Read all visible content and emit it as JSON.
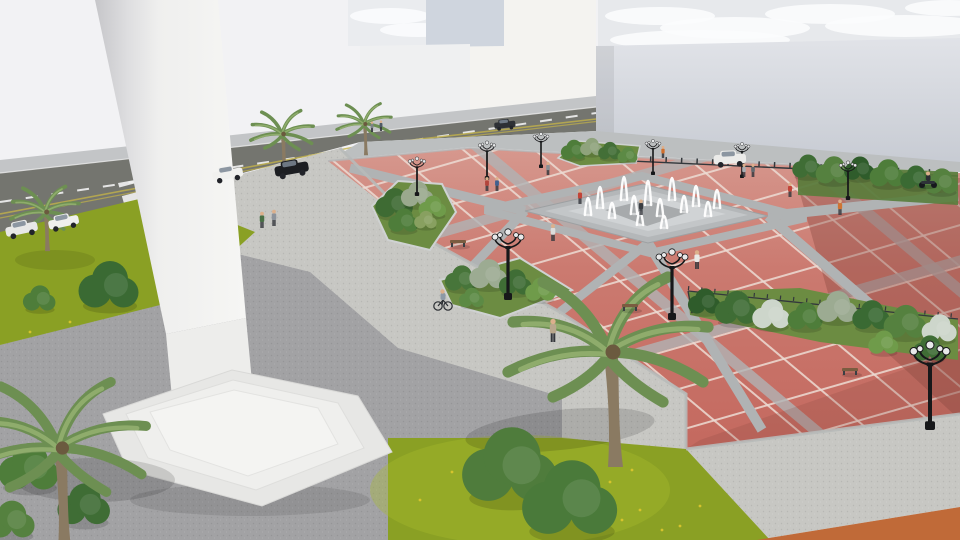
{
  "scene": {
    "description": "3D architectural rendering of a public plaza: white monument on stepped base at left, red paved square with diamond grid, central fountain with water jets, landscaped planters, palm trees, ornate lamp posts, street with cars at top and large white buildings"
  },
  "palette": {
    "sky": "#f2f2f4",
    "cloud_band": "#e7e9ec",
    "cloud": "#fbfcfd",
    "wall_top": "#e1e3e8",
    "wall_bottom": "#c6cad2",
    "building_white": "#eff0f1",
    "building_cream": "#f4f3f0",
    "building_blue": "#cfd5de",
    "street": "#74756f",
    "sidewalk_far": "#c3c5c7",
    "sidewalk_strip": "#bcbfc0",
    "walkway": "#c7c7c3",
    "plaza_gray": "#a2a2a4",
    "grass": "#8aa024",
    "grass_light": "#a8bc2e",
    "flower": "#e2c92f",
    "red_top": "#d6988e",
    "red_mid": "#cb7a70",
    "red_low": "#c4695f",
    "red_dark": "#8a4740",
    "grid_line": "#ecdcd4",
    "grid_band": "#b0b3b4",
    "curb": "#b7bab9",
    "fountain_outer": "#b4b7b9",
    "fountain_mid": "#c3c6c8",
    "fountain_inner": "#d0d3d5",
    "fountain_core": "#a7aaac",
    "water": "#ffffff",
    "monument_edge": "#c6c6c9",
    "monument_face": "#f6f6f4",
    "base1": "#e7e7e5",
    "base2": "#efefed",
    "base3": "#f4f4f2",
    "hedge": "#6c8c42",
    "palm_frond": "#6d8f52",
    "palm_frond_light": "#8fac6c",
    "trunk": "#8a7a62",
    "metal": "#17181a",
    "fence": "#33383c",
    "skin": "#dcb08c",
    "dirt": "#c06a38",
    "mark_white": "#f2f2f2",
    "mark_yellow": "#c2b14a"
  },
  "objects": {
    "clouds": [
      [
        660,
        16,
        55,
        9
      ],
      [
        735,
        28,
        75,
        11
      ],
      [
        830,
        14,
        65,
        10
      ],
      [
        905,
        26,
        80,
        11
      ],
      [
        700,
        40,
        90,
        10
      ],
      [
        950,
        8,
        45,
        8
      ],
      [
        390,
        16,
        40,
        8
      ],
      [
        418,
        30,
        38,
        7
      ]
    ],
    "palms": [
      [
        45,
        212,
        0.85
      ],
      [
        282,
        134,
        0.78
      ],
      [
        364,
        124,
        0.68
      ],
      [
        608,
        352,
        2.5
      ],
      [
        58,
        448,
        2.2
      ]
    ],
    "lamps": [
      [
        417,
        196,
        0.55
      ],
      [
        487,
        180,
        0.55
      ],
      [
        541,
        168,
        0.5
      ],
      [
        508,
        300,
        1.0
      ],
      [
        653,
        175,
        0.5
      ],
      [
        742,
        178,
        0.5
      ],
      [
        848,
        200,
        0.55
      ],
      [
        672,
        320,
        1.0
      ],
      [
        930,
        430,
        1.25
      ]
    ],
    "bushes": [
      [
        395,
        205,
        15,
        "#3e6b33"
      ],
      [
        418,
        196,
        13,
        "#9aa98e"
      ],
      [
        433,
        208,
        11,
        "#6f9b4a"
      ],
      [
        404,
        222,
        12,
        "#4e7d3a"
      ],
      [
        426,
        221,
        9,
        "#88a060"
      ],
      [
        462,
        280,
        13,
        "#47753a"
      ],
      [
        489,
        276,
        15,
        "#9cab92"
      ],
      [
        516,
        284,
        13,
        "#3f6d35"
      ],
      [
        541,
        291,
        12,
        "#6f9b4a"
      ],
      [
        472,
        299,
        10,
        "#5c8a45"
      ],
      [
        574,
        151,
        10,
        "#4e7d3a"
      ],
      [
        592,
        148,
        9,
        "#8fa37c"
      ],
      [
        610,
        152,
        9,
        "#436f37"
      ],
      [
        628,
        156,
        8,
        "#5c8a45"
      ],
      [
        808,
        168,
        12,
        "#3f6d35"
      ],
      [
        834,
        172,
        14,
        "#55813f"
      ],
      [
        860,
        170,
        12,
        "#2f5c2b"
      ],
      [
        888,
        175,
        14,
        "#4e7d3a"
      ],
      [
        916,
        179,
        12,
        "#3a6a33"
      ],
      [
        942,
        183,
        13,
        "#55813f"
      ],
      [
        705,
        303,
        13,
        "#2f5c2b"
      ],
      [
        737,
        310,
        17,
        "#3f6d35"
      ],
      [
        772,
        316,
        15,
        "#cdd6cb"
      ],
      [
        806,
        318,
        14,
        "#4e7d3a"
      ],
      [
        838,
        309,
        16,
        "#9cab92"
      ],
      [
        872,
        317,
        15,
        "#3a6a33"
      ],
      [
        906,
        324,
        17,
        "#55813f"
      ],
      [
        940,
        330,
        14,
        "#cdd6cb"
      ],
      [
        884,
        344,
        12,
        "#6f9b4a"
      ],
      [
        930,
        350,
        13,
        "#3f6d35"
      ],
      [
        110,
        288,
        24,
        "#3a6a33"
      ],
      [
        40,
        300,
        13,
        "#4e7d3a"
      ],
      [
        30,
        470,
        24,
        "#4e7d3a"
      ],
      [
        85,
        507,
        21,
        "#3f6d35"
      ],
      [
        12,
        522,
        19,
        "#55813f"
      ],
      [
        512,
        470,
        38,
        "#4f7c3c"
      ],
      [
        572,
        503,
        38,
        "#4a7a3a"
      ]
    ],
    "cars": [
      [
        228,
        176,
        0.9,
        "#f1f1ef",
        -10
      ],
      [
        292,
        171,
        1.0,
        "#1c1e22",
        -10
      ],
      [
        505,
        126,
        0.62,
        "#2d3035",
        -6
      ],
      [
        64,
        224,
        0.9,
        "#efefed",
        -12
      ],
      [
        22,
        231,
        0.95,
        "#e8e8e6",
        -12
      ],
      [
        730,
        161,
        0.95,
        "#ebebe9",
        -3
      ]
    ],
    "people": [
      [
        262,
        228,
        "#4a7046"
      ],
      [
        274,
        226,
        "#8d939b"
      ],
      [
        487,
        191,
        "#b3453c"
      ],
      [
        497,
        191,
        "#41608f"
      ],
      [
        548,
        175,
        "#8a8f94"
      ],
      [
        580,
        204,
        "#c24438"
      ],
      [
        553,
        241,
        "#dcdcda"
      ],
      [
        641,
        215,
        "#3a3d42"
      ],
      [
        697,
        269,
        "#e9e9e7"
      ],
      [
        744,
        177,
        "#a9adb2"
      ],
      [
        753,
        177,
        "#62686e"
      ],
      [
        790,
        197,
        "#c24438"
      ],
      [
        840,
        215,
        "#cf7433"
      ],
      [
        663,
        158,
        "#d06f2d"
      ],
      [
        372,
        132,
        "#7e848a"
      ],
      [
        381,
        131,
        "#4f5a66"
      ],
      [
        553,
        342,
        "#b9a78d"
      ]
    ],
    "riders": [
      {
        "type": "bike",
        "x": 443,
        "y": 306,
        "c": "#8d99a6"
      },
      {
        "type": "scooter",
        "x": 928,
        "y": 185,
        "c": "#2b2e33"
      }
    ],
    "benches": [
      [
        630,
        308
      ],
      [
        850,
        372
      ],
      [
        458,
        244
      ]
    ],
    "jets": [
      [
        588,
        215,
        34
      ],
      [
        600,
        208,
        42
      ],
      [
        612,
        218,
        30
      ],
      [
        624,
        200,
        46
      ],
      [
        634,
        214,
        36
      ],
      [
        648,
        205,
        48
      ],
      [
        660,
        216,
        34
      ],
      [
        672,
        200,
        44
      ],
      [
        684,
        212,
        32
      ],
      [
        696,
        206,
        40
      ],
      [
        708,
        216,
        28
      ],
      [
        717,
        208,
        36
      ],
      [
        640,
        225,
        26
      ],
      [
        664,
        228,
        24
      ]
    ],
    "flowers": [
      [
        600,
        500
      ],
      [
        622,
        520
      ],
      [
        585,
        526
      ],
      [
        640,
        510
      ],
      [
        662,
        530
      ],
      [
        700,
        506
      ],
      [
        420,
        500
      ],
      [
        452,
        472
      ],
      [
        610,
        482
      ],
      [
        560,
        516
      ],
      [
        680,
        526
      ],
      [
        632,
        470
      ],
      [
        30,
        332
      ],
      [
        70,
        322
      ]
    ]
  }
}
